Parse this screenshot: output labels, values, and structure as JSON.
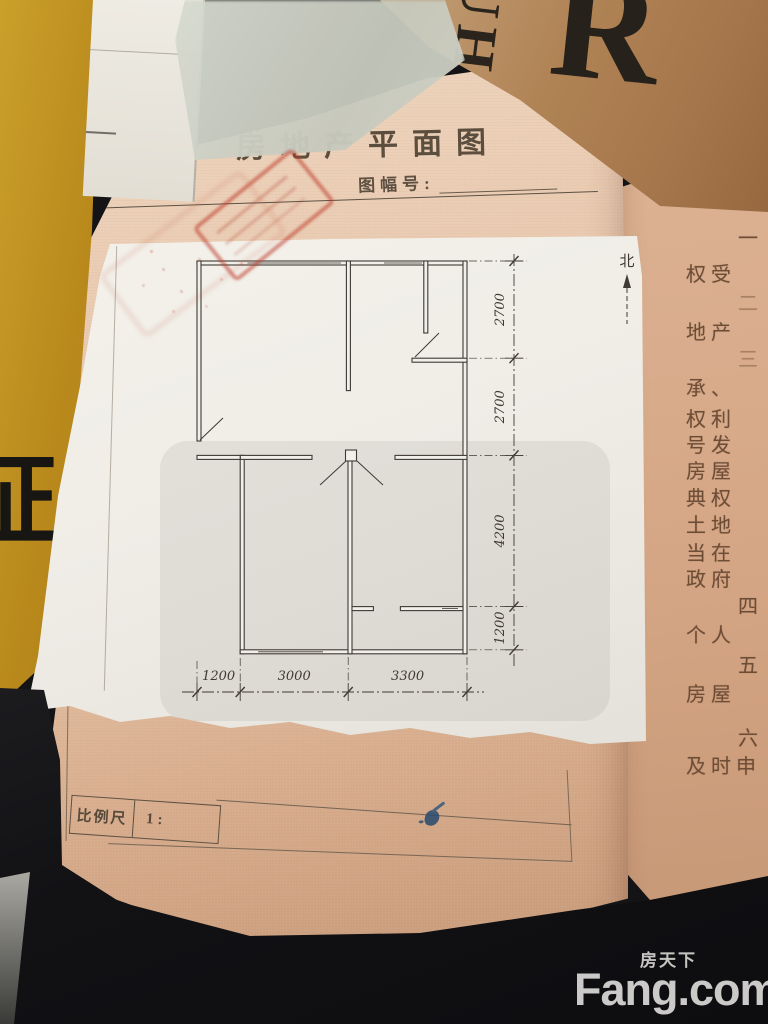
{
  "document": {
    "title": "房地产平面图",
    "sheet_no_label": "图幅号:",
    "scale_label": "比例尺",
    "scale_value": "1:"
  },
  "floor_plan": {
    "north_label": "北",
    "dims_right": [
      "2700",
      "2700",
      "4200",
      "1200"
    ],
    "dims_bottom": [
      "1200",
      "3000",
      "3300"
    ]
  },
  "right_page": {
    "lines": [
      {
        "t": "一"
      },
      {
        "t": "权受"
      },
      {
        "t": "二"
      },
      {
        "t": "地产"
      },
      {
        "t": "三"
      },
      {
        "t": "承、"
      },
      {
        "t": "权利"
      },
      {
        "t": "号发"
      },
      {
        "t": "房屋"
      },
      {
        "t": "典权"
      },
      {
        "t": "土地"
      },
      {
        "t": "当在"
      },
      {
        "t": "政府"
      },
      {
        "t": "四"
      },
      {
        "t": "个人"
      },
      {
        "t": "五"
      },
      {
        "t": "房屋"
      },
      {
        "t": "六"
      },
      {
        "t": "及时申"
      }
    ]
  },
  "background_objects": {
    "folder_glyph": "证",
    "cover_letter_r": "R",
    "cover_letters_uh": "UH"
  },
  "watermark": {
    "brand_cn": "房天下",
    "brand_en": "Fang.com"
  },
  "colors": {
    "stamp_red": "#c0392b",
    "ink": "#3f3a33",
    "page_pink": "#e7c6ab",
    "paper_white": "#f0eee7",
    "folder_yellow": "#c2951c",
    "watermark_gray": "#e8e7e4"
  }
}
